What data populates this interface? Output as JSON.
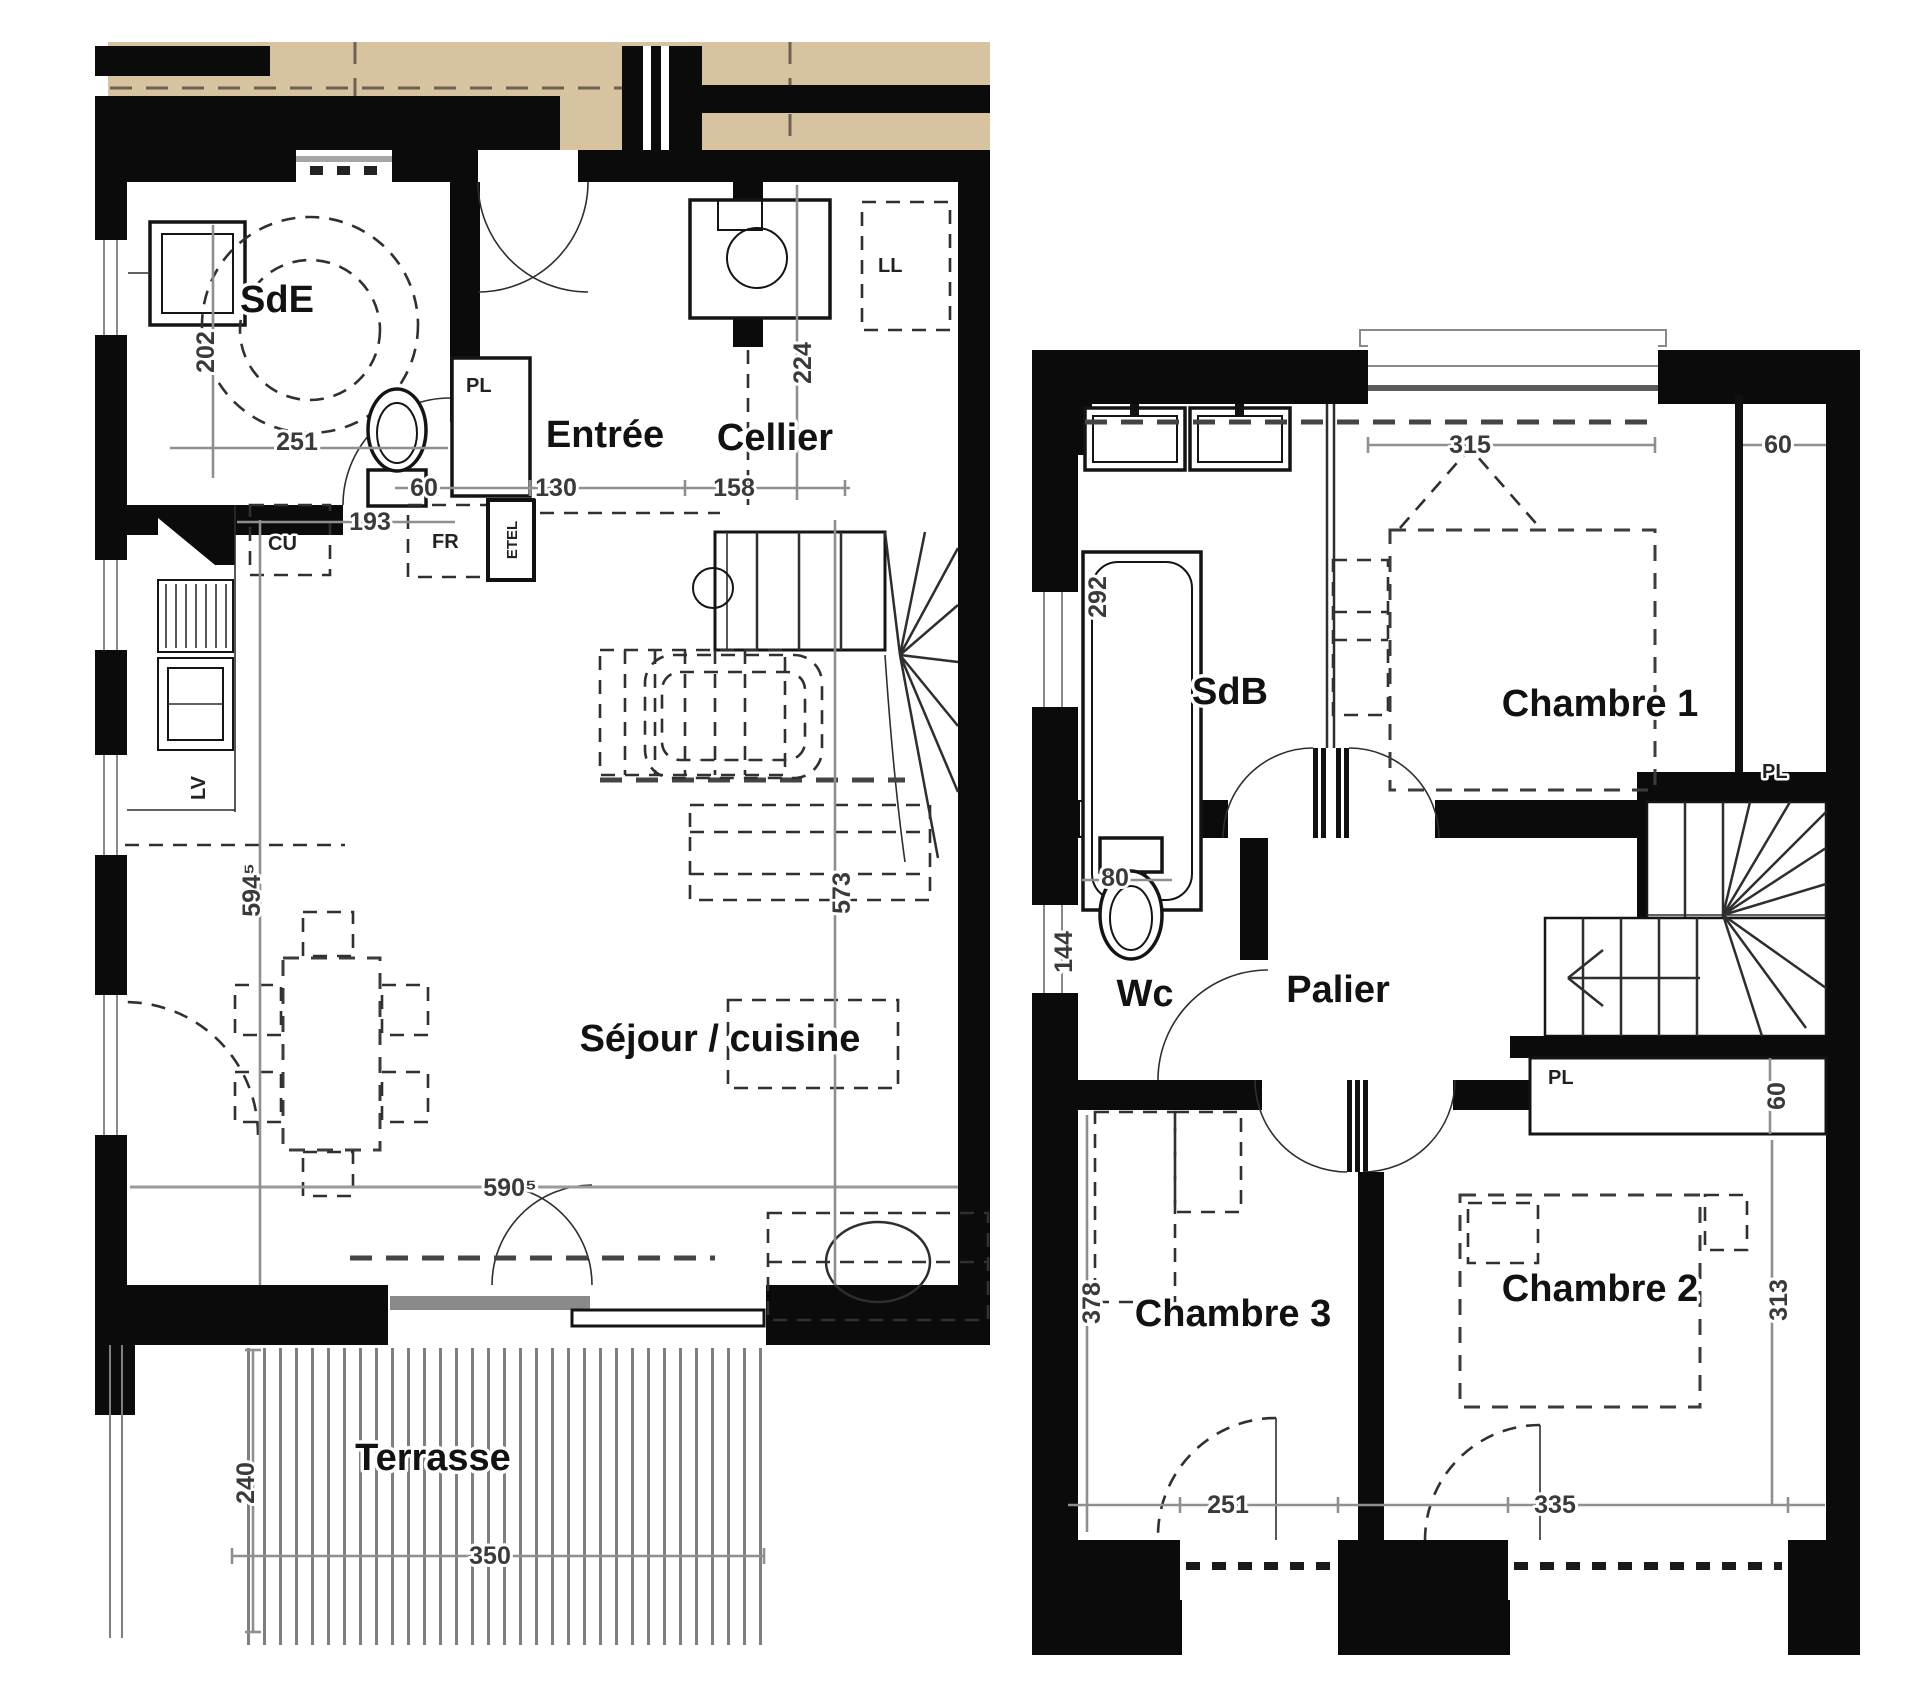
{
  "ground_floor": {
    "rooms": {
      "sde": "SdE",
      "entree": "Entrée",
      "cellier": "Cellier",
      "sejour_cuisine": "Séjour / cuisine",
      "terrasse": "Terrasse"
    },
    "fixtures": {
      "pl": "PL",
      "etel": "ETEL",
      "fr": "FR",
      "cu": "CU",
      "lv": "LV",
      "ll": "LL"
    },
    "dims": {
      "sde_height": "202",
      "sde_width": "251",
      "closet_width": "60",
      "entree_width": "130",
      "cellier_width": "158",
      "cellier_depth": "224",
      "kitchen_width": "193",
      "interior_height": "594⁵",
      "living_height": "573",
      "bay_width": "590⁵",
      "terrasse_depth": "240",
      "terrasse_width": "350"
    }
  },
  "first_floor": {
    "rooms": {
      "sdb": "SdB",
      "chambre1": "Chambre 1",
      "wc": "Wc",
      "palier": "Palier",
      "chambre3": "Chambre 3",
      "chambre2": "Chambre 2"
    },
    "fixtures": {
      "pl_chambre1": "PL",
      "pl_palier": "PL"
    },
    "dims": {
      "sdb_height": "292",
      "chambre1_window": "315",
      "pl_depth": "60",
      "wc_width": "80",
      "wc_depth": "144",
      "chambre3_height": "378",
      "chambre3_window": "251",
      "chambre2_window": "335",
      "chambre2_height": "313",
      "pl_palier_depth": "60"
    }
  },
  "colors": {
    "wall": "#0b0b0b",
    "upper_overhang": "#d8c3a0",
    "dim_line": "#8f8f8f",
    "paper": "#ffffff"
  }
}
